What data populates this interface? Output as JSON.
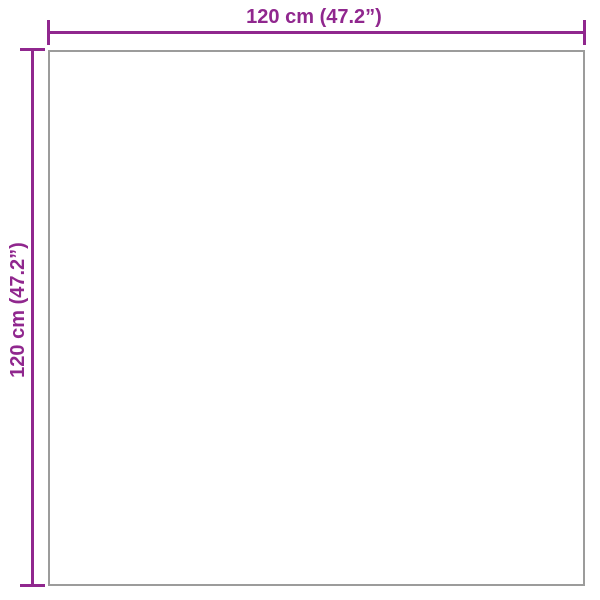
{
  "diagram": {
    "type": "product-dimension-diagram",
    "shape": "square",
    "width": {
      "label": "120 cm (47.2”)",
      "value_cm": 120,
      "value_inches": 47.2
    },
    "height": {
      "label": "120 cm (47.2”)",
      "value_cm": 120,
      "value_inches": 47.2
    },
    "colors": {
      "dimension": "#90278e",
      "outline": "#9c9c9b",
      "background": "#ffffff"
    }
  }
}
